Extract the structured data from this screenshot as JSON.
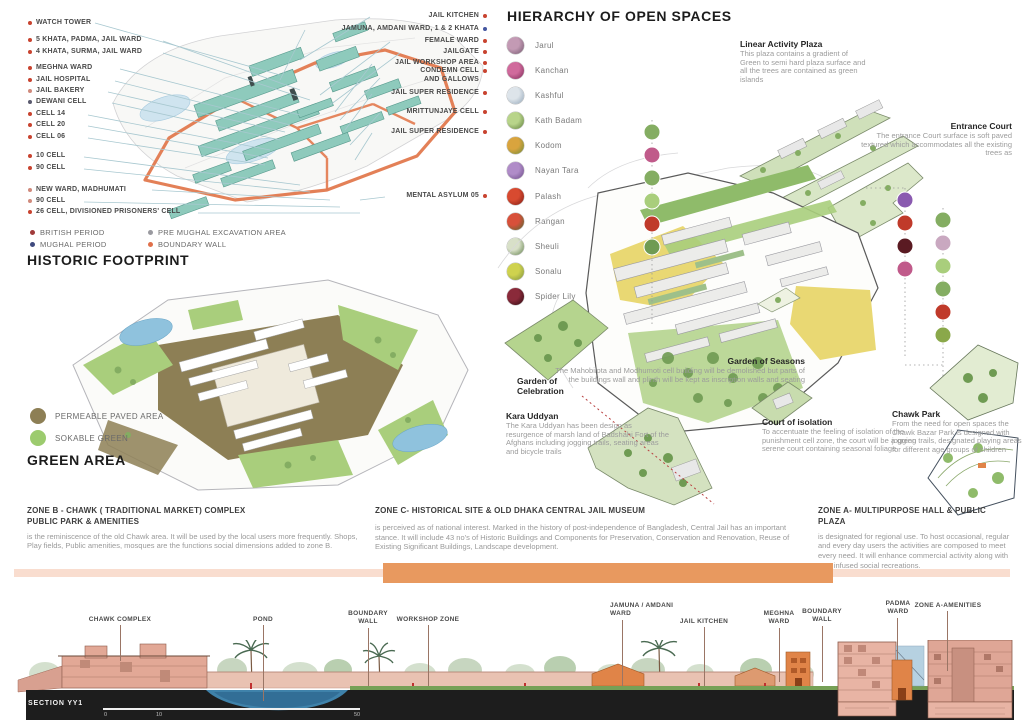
{
  "jail_map": {
    "left_labels": [
      {
        "text": "WATCH TOWER",
        "dot": "#c8432f"
      },
      {
        "text": "5 KHATA, PADMA, JAIL WARD",
        "dot": "#c8432f"
      },
      {
        "text": "4 KHATA, SURMA, JAIL WARD",
        "dot": "#c8432f"
      },
      {
        "text": "MEGHNA WARD",
        "dot": "#c8432f"
      },
      {
        "text": "JAIL HOSPITAL",
        "dot": "#c8432f"
      },
      {
        "text": "JAIL BAKERY",
        "dot": "#d08a7c"
      },
      {
        "text": "DEWANI CELL",
        "dot": "#5a5a6e"
      },
      {
        "text": "CELL 14",
        "dot": "#c8432f"
      },
      {
        "text": "CELL 20",
        "dot": "#c8432f"
      },
      {
        "text": "CELL 06",
        "dot": "#c8432f"
      },
      {
        "text": "10 CELL",
        "dot": "#c8432f"
      },
      {
        "text": "90 CELL",
        "dot": "#c8432f"
      },
      {
        "text": "NEW  WARD, MADHUMATI",
        "dot": "#d08a7c"
      },
      {
        "text": "90 CELL",
        "dot": "#d08a7c"
      },
      {
        "text": "26 CELL, DIVISIONED PRISONERS' CELL",
        "dot": "#c8432f"
      }
    ],
    "right_labels": [
      {
        "text": "JAIL KITCHEN",
        "dot": "#c8432f"
      },
      {
        "text": "JAMUNA, AMDANI WARD, 1 & 2 KHATA",
        "dot": "#4456a0"
      },
      {
        "text": "FEMALE WARD",
        "dot": "#c8432f"
      },
      {
        "text": "JAILGATE",
        "dot": "#c8432f"
      },
      {
        "text": "JAIL WORKSHOP AREA",
        "dot": "#c8432f"
      },
      {
        "text": "CONDEMN CELL AND GALLOWS",
        "dot": "#c8432f"
      },
      {
        "text": "JAIL SUPER RESIDENCE",
        "dot": "#c8432f"
      },
      {
        "text": "MRITTUNJAYE CELL",
        "dot": "#c8432f"
      },
      {
        "text": "JAIL SUPER RESIDENCE",
        "dot": "#c8432f"
      },
      {
        "text": "MENTAL ASYLUM 05",
        "dot": "#c8432f"
      }
    ],
    "legend": [
      {
        "label": "BRITISH PERIOD",
        "dot": "#a03a3a"
      },
      {
        "label": "MUGHAL PERIOD",
        "dot": "#3f4a7e"
      },
      {
        "label": "PRE MUGHAL EXCAVATION AREA",
        "dot": "#9a9aa0"
      },
      {
        "label": "BOUNDARY WALL",
        "dot": "#e0704a"
      }
    ]
  },
  "historic": {
    "title": "HISTORIC FOOTPRINT",
    "legend": [
      {
        "label": "PERMEABLE PAVED AREA",
        "color": "#8d7f55"
      },
      {
        "label": "SOKABLE GREEN",
        "color": "#9ccb6e"
      }
    ],
    "green_area_title": "GREEN AREA"
  },
  "hierarchy": {
    "title": "HIERARCHY OF OPEN SPACES",
    "plants": [
      {
        "name": "Jarul",
        "c1": "#c39ab4",
        "c2": "#70566c"
      },
      {
        "name": "Kanchan",
        "c1": "#d06a9c",
        "c2": "#7c2a56"
      },
      {
        "name": "Kashful",
        "c1": "#dde4ea",
        "c2": "#8fa3b5"
      },
      {
        "name": "Kath Badam",
        "c1": "#b8d48a",
        "c2": "#5c7c3a"
      },
      {
        "name": "Kodom",
        "c1": "#d9a43e",
        "c2": "#6a8a3a"
      },
      {
        "name": "Nayan Tara",
        "c1": "#b08cc8",
        "c2": "#6a4a86"
      },
      {
        "name": "Palash",
        "c1": "#d84a30",
        "c2": "#7c1a14"
      },
      {
        "name": "Rangan",
        "c1": "#d8503a",
        "c2": "#4c6a32"
      },
      {
        "name": "Sheuli",
        "c1": "#d8e0c8",
        "c2": "#5c7c46"
      },
      {
        "name": "Sonalu",
        "c1": "#cfd24e",
        "c2": "#7c9040"
      },
      {
        "name": "Spider Lily",
        "c1": "#8a2a3a",
        "c2": "#28080e"
      }
    ]
  },
  "annotations": {
    "linear_activity_plaza": {
      "title": "Linear Activity Plaza",
      "body": "This plaza contains a gradient of Green to semi hard plaza surface and all the trees are contained as green islands"
    },
    "entrance_court": {
      "title": "Entrance Court",
      "body": "The entrance Court surface is soft paved textured which accommodates all the existing trees as"
    },
    "garden_of_celebration": {
      "title": "Garden of Celebration"
    },
    "garden_of_seasons": {
      "title": "Garden of Seasons",
      "body": "The Mahobilota and Modhumoti cell building will be demolished but parts of the buildings wall and plinth will be kept as inscription walls and seating"
    },
    "kara_uddyan": {
      "title": "Kara Uddyan",
      "body": "The Kara Uddyan has been design as resurgence of marsh land of Badshahi Fort of the Afghans including jogging trails, seating areas and bicycle trails"
    },
    "court_of_isolation": {
      "title": "Court of isolation",
      "body": "To accentuate the feeling of isolation of the punishment cell zone, the court will be a green serene court containing seasonal foliage"
    },
    "chawk_park": {
      "title": "Chawk Park",
      "body": "From the need for open spaces the Chawk Bazar Park is designed with jogging trails, designated playing areas for different age groups of children"
    }
  },
  "zones": {
    "b": {
      "title_line1": "ZONE B - CHAWK ( TRADITIONAL MARKET) COMPLEX",
      "title_line2": "PUBLIC PARK & AMENITIES",
      "body": "is the reminiscence of the old Chawk area. It will be used by the local users more frequently. Shops, Play fields, Public amenities, mosques are the functions social dimensions added to zone B."
    },
    "c": {
      "title": "ZONE C- HISTORICAL SITE & OLD DHAKA CENTRAL JAIL MUSEUM",
      "body": "is perceived as of national interest. Marked in the history of post-independence of Bangladesh, Central Jail has an important stance. It will include 43 no's of Historic Buildings and Components for Preservation, Conservation and Renovation, Reuse of Existing Significant Buildings, Landscape development."
    },
    "a": {
      "title": "ZONE A- MULTIPURPOSE HALL & PUBLIC PLAZA",
      "body": "is designated for regional use.  To host occasional, regular and every day users the activities are composed to meet every need. It will enhance commercial activity along with new infused social recreations."
    }
  },
  "section": {
    "name": "SECTION YY1",
    "labels": [
      "CHAWK COMPLEX",
      "POND",
      "BOUNDARY WALL",
      "WORKSHOP ZONE",
      "JAMUNA / AMDANI WARD",
      "JAIL KITCHEN",
      "MEGHNA WARD",
      "BOUNDARY WALL",
      "PADMA WARD",
      "ZONE A-AMENITIES"
    ],
    "scale_ticks": [
      "0",
      "10",
      "50"
    ]
  }
}
